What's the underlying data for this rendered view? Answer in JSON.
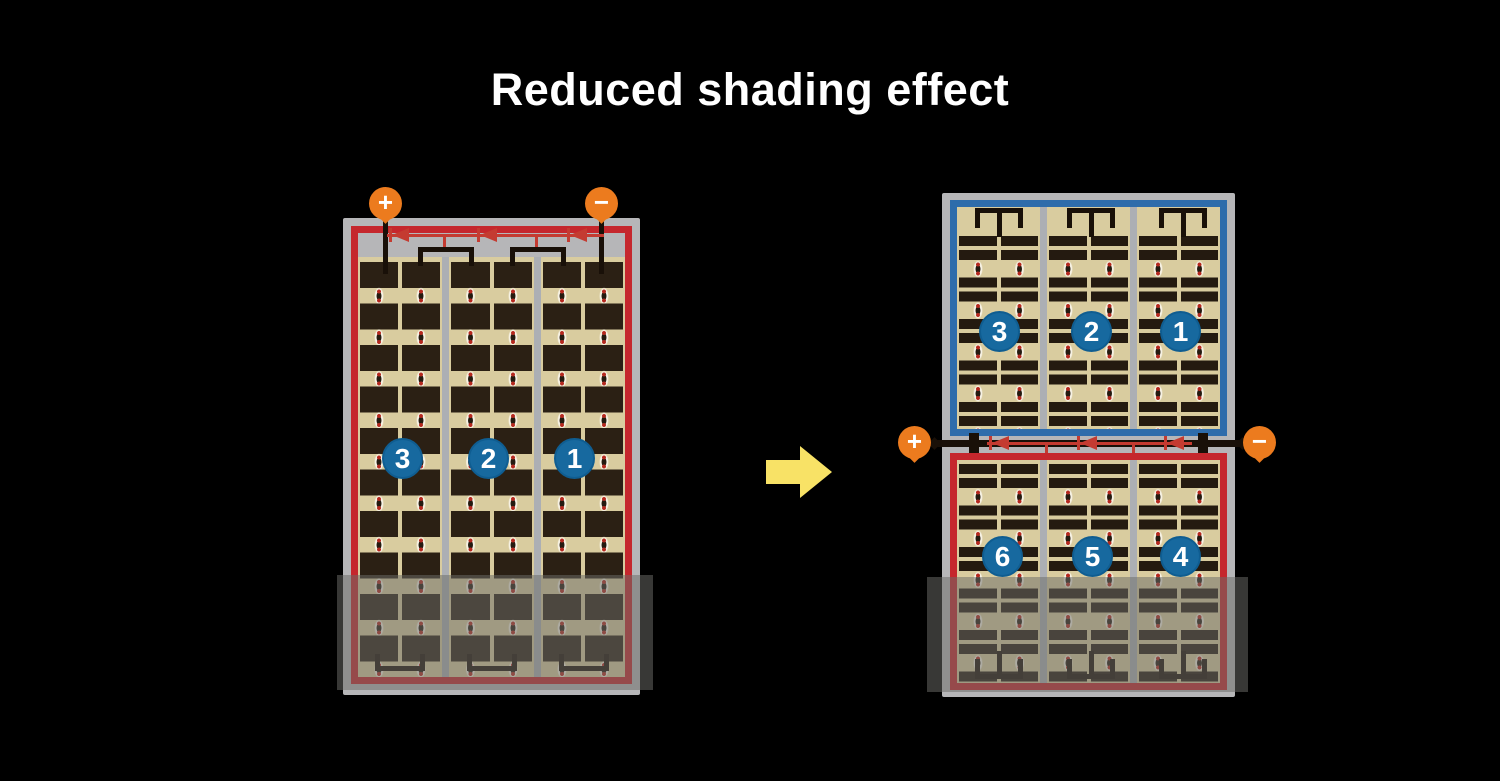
{
  "title": "Reduced shading effect",
  "colors": {
    "background": "#000000",
    "panel_frame_gray": "#b6b6b8",
    "cell_beige": "#d9cc9f",
    "cell_dark": "#2b2014",
    "red_wire": "#c5272d",
    "diode_red": "#c43b31",
    "blue_wire": "#2e6cab",
    "terminal_orange": "#ec7b1e",
    "number_circle_blue": "#17699f",
    "arrow_yellow": "#f8e266",
    "shade_overlay": "rgba(108,108,104,0.52)"
  },
  "left_panel": {
    "terminals": {
      "positive": "+",
      "negative": "−"
    },
    "group_labels": [
      "3",
      "2",
      "1"
    ]
  },
  "right_panel": {
    "terminals": {
      "positive": "+",
      "negative": "−"
    },
    "top_group_labels": [
      "3",
      "2",
      "1"
    ],
    "bottom_group_labels": [
      "6",
      "5",
      "4"
    ]
  }
}
